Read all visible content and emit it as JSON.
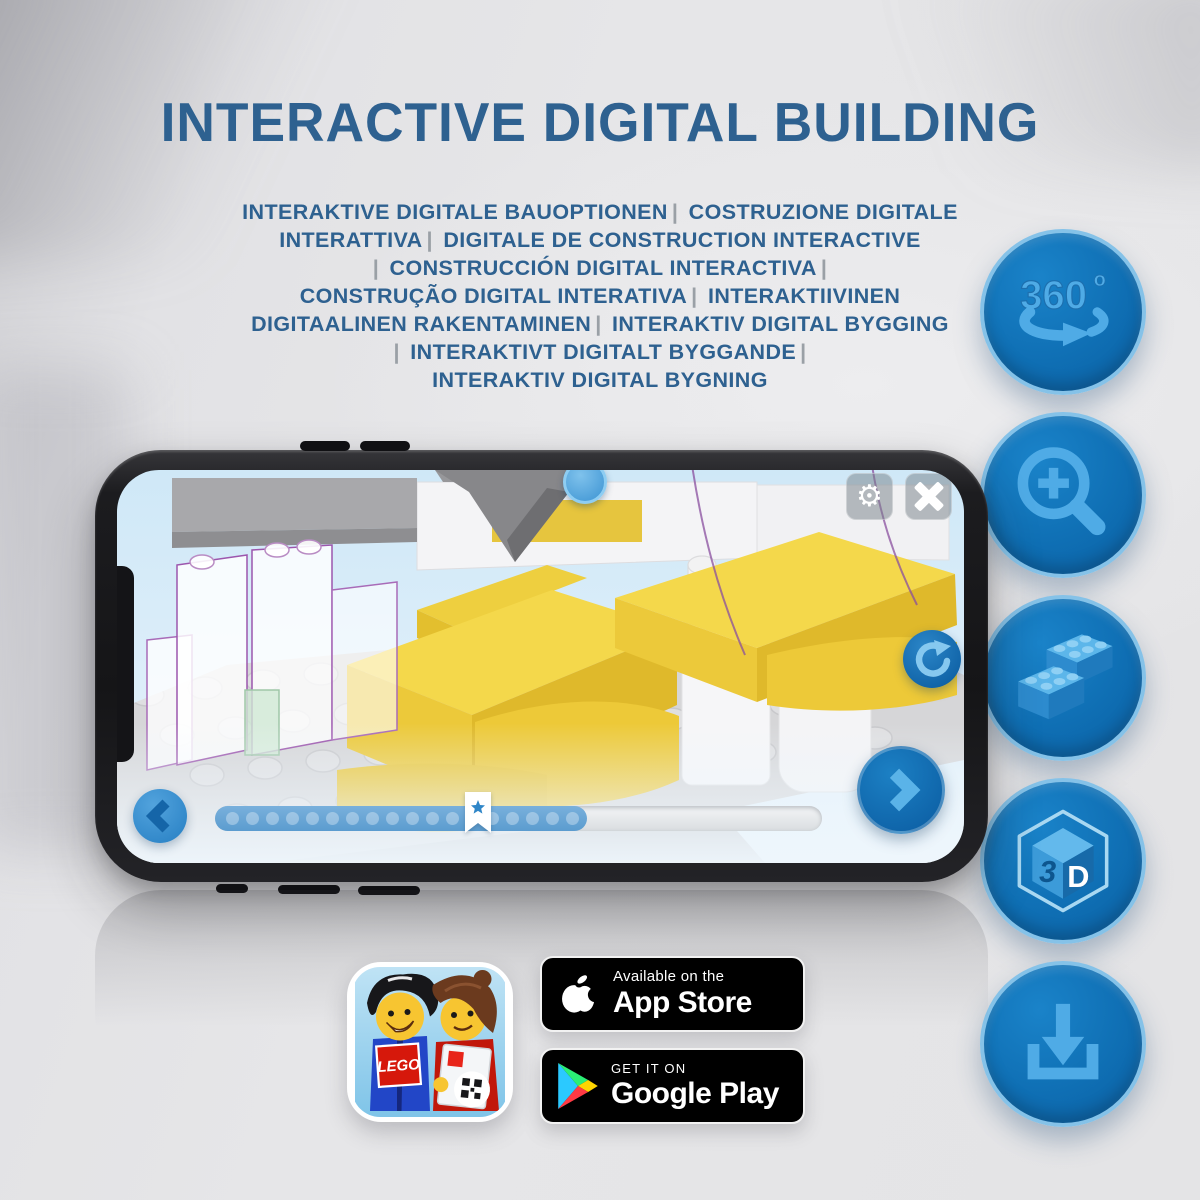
{
  "title": "INTERACTIVE DIGITAL BUILDING",
  "subtitle": {
    "lines": [
      "INTERAKTIVE DIGITALE BAUOPTIONEN | COSTRUZIONE DIGITALE",
      "INTERATTIVA | DIGITALE DE CONSTRUCTION INTERACTIVE",
      "| CONSTRUCCIÓN DIGITAL INTERACTIVA |",
      "CONSTRUÇÃO DIGITAL INTERATIVA | INTERAKTIIVINEN",
      "DIGITAALINEN RAKENTAMINEN | INTERAKTIV DIGITAL BYGGING",
      "| INTERAKTIVT DIGITALT BYGGANDE |",
      "INTERAKTIV DIGITAL BYGNING"
    ]
  },
  "colors": {
    "title_blue": "#2e6190",
    "separator_gray": "#9aa0a6",
    "feature_circle_blue": "#0f6fb4",
    "feature_rim_blue": "#85c2e8",
    "feature_glyph_blue": "#4fabe6",
    "brick_yellow": "#f4d84b",
    "screen_sky_blue": "#d7ebf7"
  },
  "features": [
    {
      "name": "360-rotation-icon",
      "label": "360",
      "degree": "o"
    },
    {
      "name": "zoom-in-icon"
    },
    {
      "name": "brick-stack-icon"
    },
    {
      "name": "3d-cube-icon",
      "left": "3",
      "right": "D"
    },
    {
      "name": "download-icon"
    }
  ],
  "phone": {
    "slider": {
      "dot_count": 18
    },
    "hud_icons": [
      "settings-gear",
      "close-x",
      "rotate-refresh",
      "previous-arrow",
      "next-arrow",
      "star-bookmark"
    ]
  },
  "store_row": {
    "lego_logo_text": "LEGO",
    "app_store_badge": {
      "top": "Available on the",
      "bottom": "App Store"
    },
    "google_play_badge": {
      "top": "GET IT ON",
      "bottom": "Google Play"
    }
  }
}
